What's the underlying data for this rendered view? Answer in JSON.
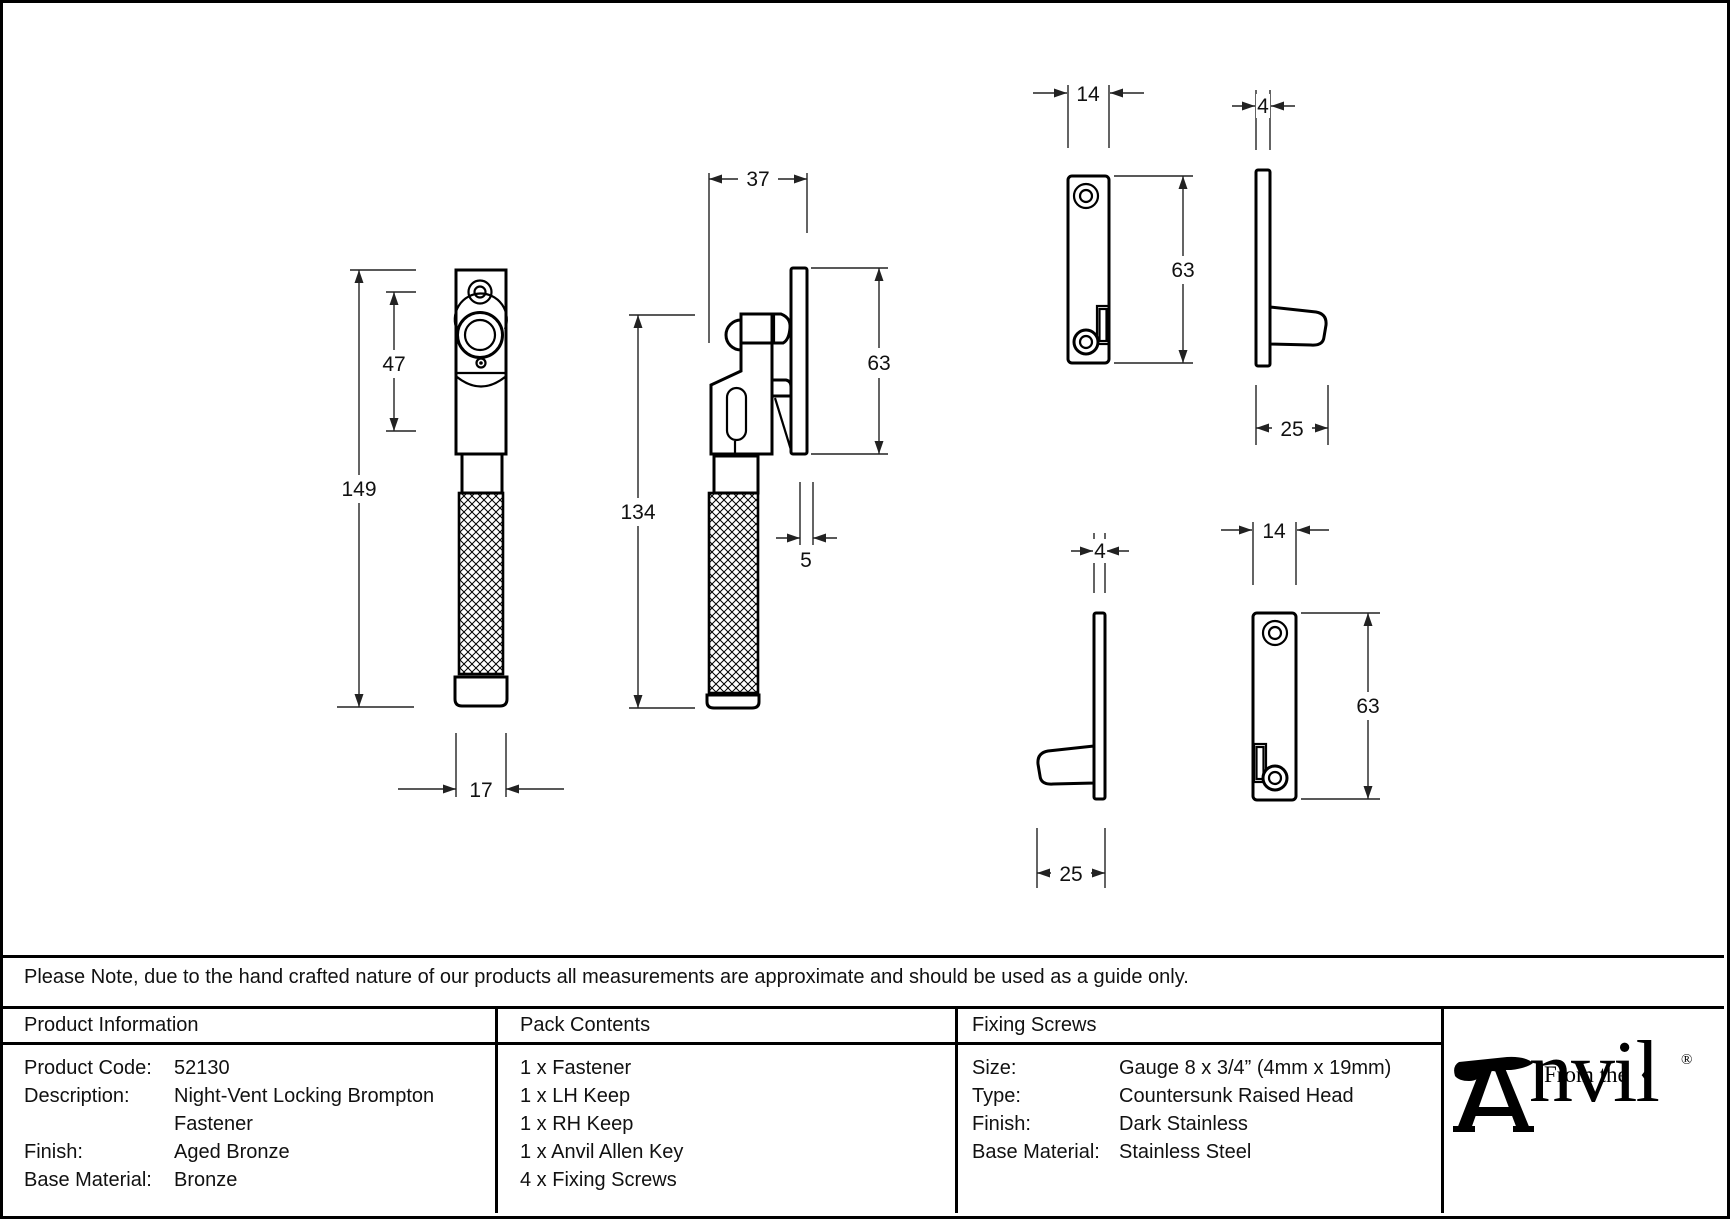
{
  "note": "Please Note, due to the hand crafted nature of our products all measurements are approximate and should be used as a guide only.",
  "drawing": {
    "front": {
      "height": "149",
      "upper": "47",
      "width": "17"
    },
    "side": {
      "depth": "37",
      "height": "134",
      "keep_height": "63",
      "protrusion": "5"
    },
    "keep_lh": {
      "width": "14",
      "height": "63"
    },
    "keep_lh_side": {
      "thickness": "4",
      "depth": "25"
    },
    "keep_rh_side": {
      "thickness": "4",
      "depth": "25"
    },
    "keep_rh": {
      "width": "14",
      "height": "63"
    }
  },
  "table": {
    "product_information": {
      "title": "Product Information",
      "rows": [
        {
          "label": "Product Code:",
          "value": "52130"
        },
        {
          "label": "Description:",
          "value": "Night-Vent Locking Brompton"
        },
        {
          "label": "",
          "value": "Fastener"
        },
        {
          "label": "Finish:",
          "value": "Aged Bronze"
        },
        {
          "label": "Base Material:",
          "value": "Bronze"
        }
      ]
    },
    "pack_contents": {
      "title": "Pack Contents",
      "items": [
        "1 x Fastener",
        "1 x LH Keep",
        "1 x RH Keep",
        "1 x Anvil Allen Key",
        "4 x Fixing Screws"
      ]
    },
    "fixing_screws": {
      "title": "Fixing Screws",
      "rows": [
        {
          "label": "Size:",
          "value": "Gauge 8 x 3/4” (4mm x 19mm)"
        },
        {
          "label": "Type:",
          "value": "Countersunk Raised Head"
        },
        {
          "label": "Finish:",
          "value": "Dark Stainless"
        },
        {
          "label": "Base Material:",
          "value": "Stainless Steel"
        }
      ]
    }
  },
  "logo": {
    "from_the": "From the",
    "anvil": "nvil",
    "diamond": "♦",
    "registered": "®"
  }
}
